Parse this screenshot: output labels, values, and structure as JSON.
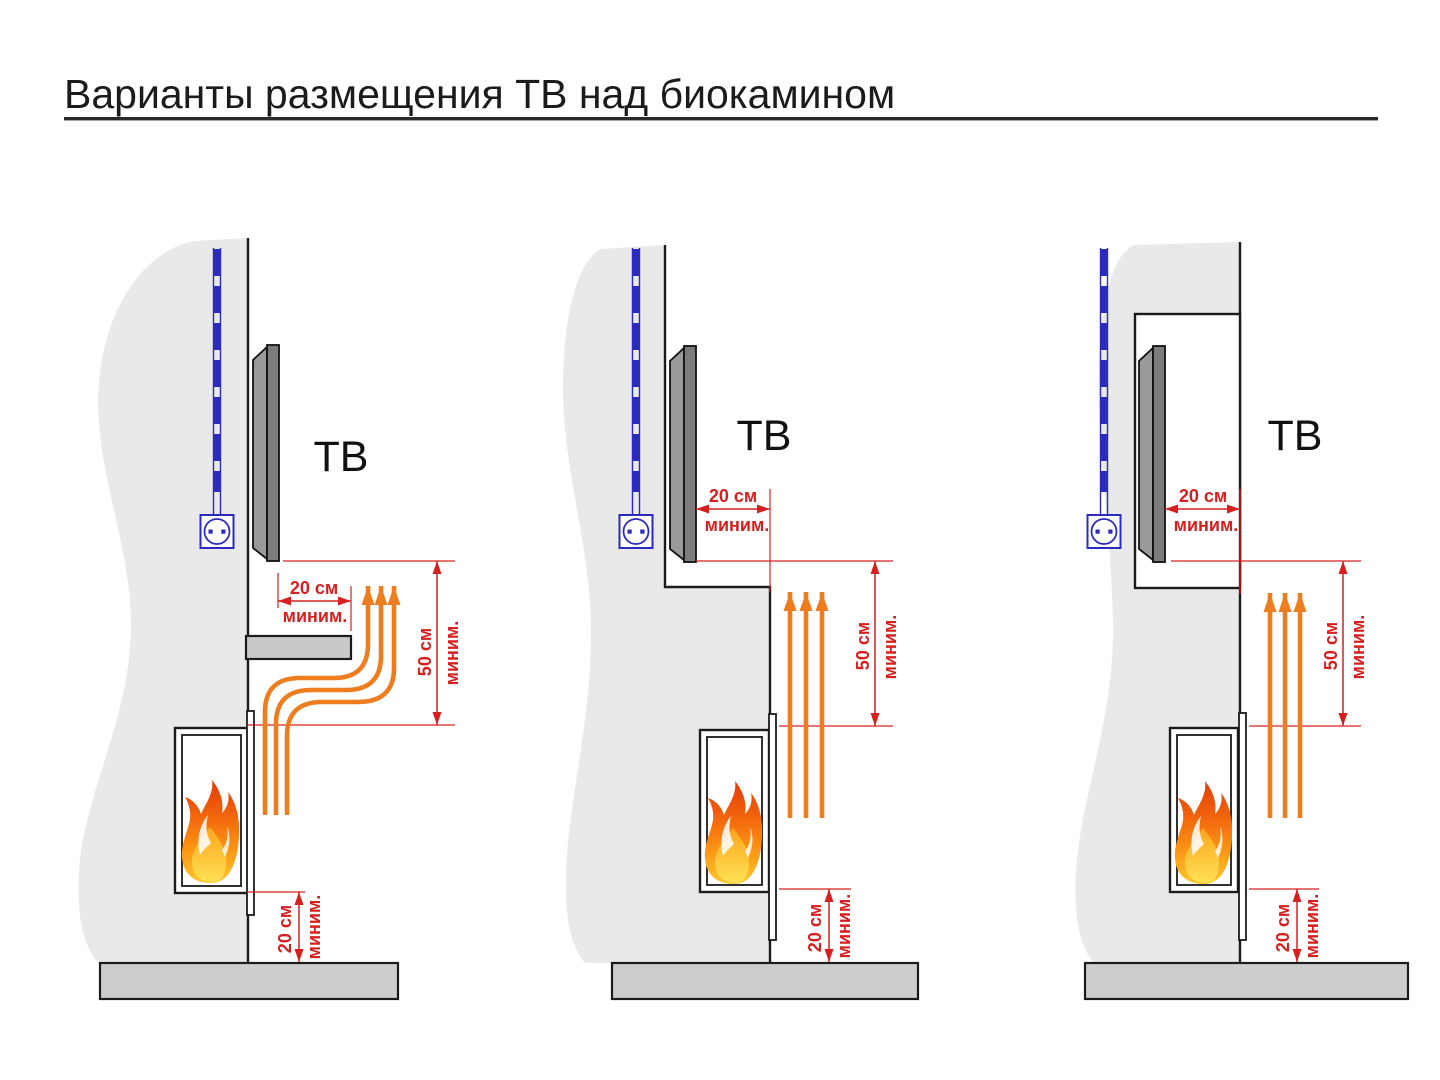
{
  "title": "Варианты размещения ТВ над биокамином",
  "colors": {
    "accent_red": "#d6201f",
    "heat_orange": "#ee7d1f",
    "electric_blue": "#2b2bbd",
    "wall_gray": "#e9e9e9",
    "floor_gray": "#cdcdcd",
    "tv_gray": "#7c7c7c",
    "text_black": "#1b1b1b",
    "flame_palette": [
      "#e03407",
      "#f1630c",
      "#fb9313",
      "#ffc72b",
      "#ffe054"
    ]
  },
  "icons": {
    "power_outlet": "outlet-circle-with-two-pins",
    "power_cable": "blue-dashed-conduit",
    "flame": "layered-fire-shape",
    "heat_flow": "orange-up-arrows",
    "dimension_arrow": "red-double-headed-arrow"
  },
  "variants": [
    {
      "id": "tv-on-wall-with-protective-shelf",
      "tv_label": "ТВ",
      "dim_front": {
        "value": "20 см",
        "qualifier": "миним."
      },
      "dim_above": {
        "value": "50 см",
        "qualifier": "миним."
      },
      "dim_floor": {
        "value": "20 см",
        "qualifier": "миним."
      }
    },
    {
      "id": "tv-recessed-behind-fireplace-ledge",
      "tv_label": "ТВ",
      "dim_front": {
        "value": "20 см",
        "qualifier": "миним."
      },
      "dim_above": {
        "value": "50 см",
        "qualifier": "миним."
      },
      "dim_floor": {
        "value": "20 см",
        "qualifier": "миним."
      }
    },
    {
      "id": "tv-inside-wall-niche",
      "tv_label": "ТВ",
      "dim_front": {
        "value": "20 см",
        "qualifier": "миним."
      },
      "dim_above": {
        "value": "50 см",
        "qualifier": "миним."
      },
      "dim_floor": {
        "value": "20 см",
        "qualifier": "миним."
      }
    }
  ]
}
